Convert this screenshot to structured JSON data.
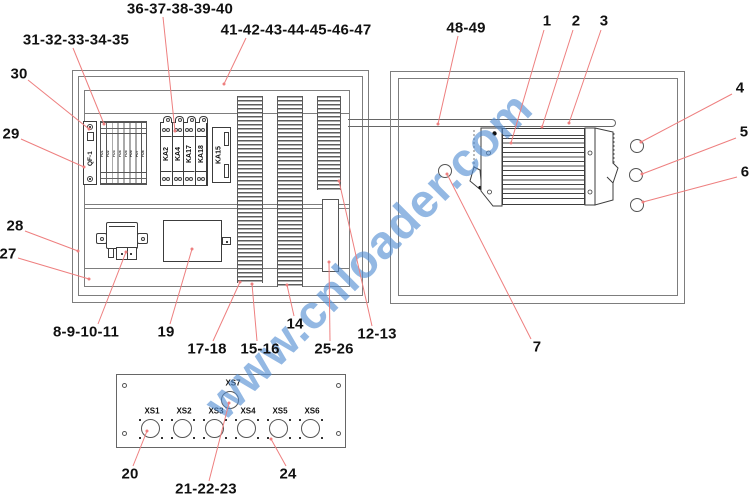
{
  "figure": {
    "type": "exploded-parts-callout-diagram",
    "subject": "electrical control box assembly"
  },
  "watermark": {
    "text": "www.cnloader.com",
    "color": "rgba(80,140,210,0.62)"
  },
  "colors": {
    "leader_line": "#ee7f7f",
    "frame_line": "#7d7d7d",
    "component_line": "#3c3c3c",
    "label_text": "#111111"
  },
  "left_cabinet": {
    "breaker_label": "QF-1",
    "fuse_labels": [
      "FU1",
      "FU2",
      "FU3",
      "FU4",
      "FU5",
      "FU6",
      "FU7",
      "FU8"
    ],
    "relay_labels": [
      "KA2",
      "KA4",
      "KA17",
      "KA18"
    ],
    "side_relay_label": "KA15"
  },
  "bottom_panel": {
    "top_connector_label": "XS7",
    "connector_labels": [
      "XS1",
      "XS2",
      "XS3",
      "XS4",
      "XS5",
      "XS6"
    ]
  },
  "callouts": [
    {
      "text": "36-37-38-39-40",
      "x": 180,
      "y": 9,
      "x1": 163,
      "y1": 17,
      "x2": 175,
      "y2": 131
    },
    {
      "text": "41-42-43-44-45-46-47",
      "x": 296,
      "y": 30,
      "x1": 246,
      "y1": 38,
      "x2": 224,
      "y2": 84
    },
    {
      "text": "48-49",
      "x": 466,
      "y": 28,
      "x1": 458,
      "y1": 36,
      "x2": 438,
      "y2": 124
    },
    {
      "text": "1",
      "x": 547,
      "y": 21,
      "x1": 544,
      "y1": 30,
      "x2": 511,
      "y2": 143
    },
    {
      "text": "2",
      "x": 576,
      "y": 21,
      "x1": 573,
      "y1": 30,
      "x2": 542,
      "y2": 127
    },
    {
      "text": "3",
      "x": 604,
      "y": 21,
      "x1": 601,
      "y1": 30,
      "x2": 569,
      "y2": 123
    },
    {
      "text": "31-32-33-34-35",
      "x": 76,
      "y": 40,
      "x1": 73,
      "y1": 48,
      "x2": 104,
      "y2": 124
    },
    {
      "text": "30",
      "x": 19,
      "y": 74,
      "x1": 28,
      "y1": 80,
      "x2": 89,
      "y2": 129
    },
    {
      "text": "29",
      "x": 11,
      "y": 134,
      "x1": 21,
      "y1": 139,
      "x2": 84,
      "y2": 167
    },
    {
      "text": "4",
      "x": 740,
      "y": 88,
      "x1": 732,
      "y1": 94,
      "x2": 641,
      "y2": 142
    },
    {
      "text": "5",
      "x": 744,
      "y": 132,
      "x1": 736,
      "y1": 138,
      "x2": 642,
      "y2": 174
    },
    {
      "text": "6",
      "x": 745,
      "y": 172,
      "x1": 737,
      "y1": 177,
      "x2": 643,
      "y2": 202
    },
    {
      "text": "28",
      "x": 15,
      "y": 226,
      "x1": 25,
      "y1": 231,
      "x2": 78,
      "y2": 251
    },
    {
      "text": "27",
      "x": 8,
      "y": 254,
      "x1": 18,
      "y1": 258,
      "x2": 89,
      "y2": 279
    },
    {
      "text": "8-9-10-11",
      "x": 86,
      "y": 332,
      "x1": 98,
      "y1": 324,
      "x2": 126,
      "y2": 252
    },
    {
      "text": "19",
      "x": 166,
      "y": 332,
      "x1": 170,
      "y1": 324,
      "x2": 192,
      "y2": 249
    },
    {
      "text": "17-18",
      "x": 207,
      "y": 349,
      "x1": 213,
      "y1": 341,
      "x2": 240,
      "y2": 282
    },
    {
      "text": "15-16",
      "x": 260,
      "y": 349,
      "x1": 257,
      "y1": 341,
      "x2": 252,
      "y2": 284
    },
    {
      "text": "14",
      "x": 295,
      "y": 324,
      "x1": 294,
      "y1": 316,
      "x2": 287,
      "y2": 285
    },
    {
      "text": "25-26",
      "x": 334,
      "y": 349,
      "x1": 330,
      "y1": 341,
      "x2": 329,
      "y2": 262
    },
    {
      "text": "12-13",
      "x": 377,
      "y": 334,
      "x1": 372,
      "y1": 326,
      "x2": 339,
      "y2": 181
    },
    {
      "text": "7",
      "x": 537,
      "y": 347,
      "x1": 531,
      "y1": 339,
      "x2": 447,
      "y2": 174
    },
    {
      "text": "20",
      "x": 130,
      "y": 474,
      "x1": 133,
      "y1": 466,
      "x2": 147,
      "y2": 431
    },
    {
      "text": "21-22-23",
      "x": 206,
      "y": 489,
      "x1": 209,
      "y1": 481,
      "x2": 229,
      "y2": 403
    },
    {
      "text": "24",
      "x": 288,
      "y": 474,
      "x1": 286,
      "y1": 466,
      "x2": 271,
      "y2": 439
    }
  ]
}
